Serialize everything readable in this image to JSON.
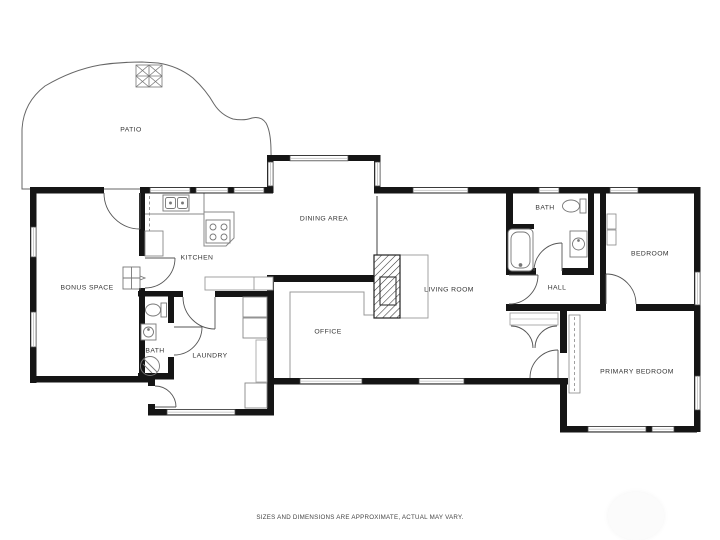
{
  "floor_plan": {
    "title": "single-story house floor plan",
    "rooms": [
      {
        "id": "patio",
        "label": "PATIO"
      },
      {
        "id": "bonus-space",
        "label": "BONUS SPACE"
      },
      {
        "id": "kitchen",
        "label": "KITCHEN"
      },
      {
        "id": "dining-area",
        "label": "DINING AREA"
      },
      {
        "id": "living-room",
        "label": "LIVING ROOM"
      },
      {
        "id": "office",
        "label": "OFFICE"
      },
      {
        "id": "laundry",
        "label": "LAUNDRY"
      },
      {
        "id": "bath-left",
        "label": "BATH"
      },
      {
        "id": "bath-right",
        "label": "BATH"
      },
      {
        "id": "hall",
        "label": "HALL"
      },
      {
        "id": "bedroom",
        "label": "BEDROOM"
      },
      {
        "id": "primary-bedroom",
        "label": "PRIMARY BEDROOM"
      }
    ],
    "fixtures": [
      "kitchen-sink",
      "stove",
      "refrigerator",
      "fireplace",
      "bathtub",
      "toilet",
      "bathroom-sink",
      "shower",
      "washer-dryer",
      "furnace",
      "closet",
      "patio-table"
    ],
    "colors": {
      "wall": "#151515",
      "line": "#777777",
      "label": "#333333",
      "background": "#ffffff"
    }
  },
  "footer": {
    "disclaimer": "SIZES AND DIMENSIONS ARE APPROXIMATE, ACTUAL MAY VARY."
  }
}
